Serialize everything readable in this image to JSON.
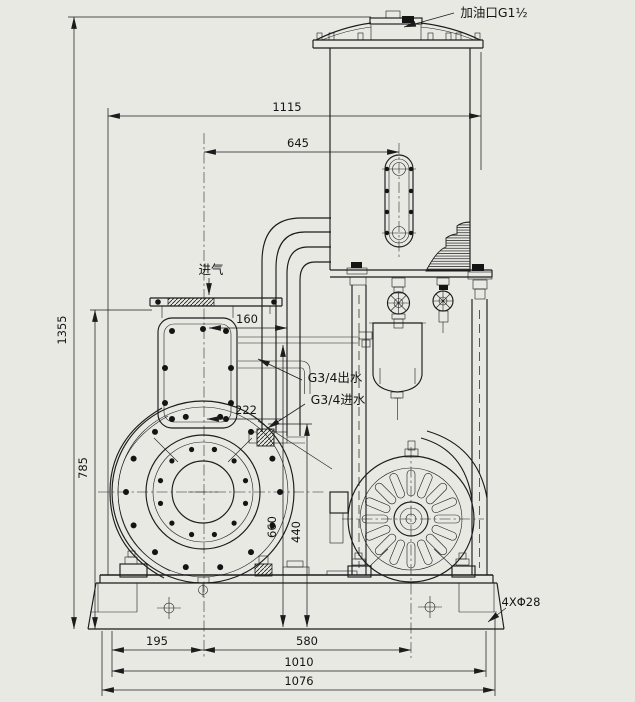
{
  "drawing": {
    "type": "engineering-outline-drawing",
    "colors": {
      "background": "#e9e9e4",
      "ink": "#1c1c1c"
    },
    "labels": {
      "oil_port": "加油口G1½",
      "air_inlet": "进气",
      "water_outlet": "G3/4出水",
      "water_inlet": "G3/4进水",
      "base_holes": "4XΦ28"
    },
    "dimensions": {
      "overall_width": "1115",
      "sight_glass_offset": "645",
      "overall_height": "1355",
      "inlet_height": "785",
      "inlet_offset": "160",
      "water_inlet_offset": "222",
      "pipe_center_height": "660",
      "fitting_height": "440",
      "foot_to_pump_center": "195",
      "pump_to_motor_center": "580",
      "hole_span": "1010",
      "base_width": "1076"
    }
  }
}
